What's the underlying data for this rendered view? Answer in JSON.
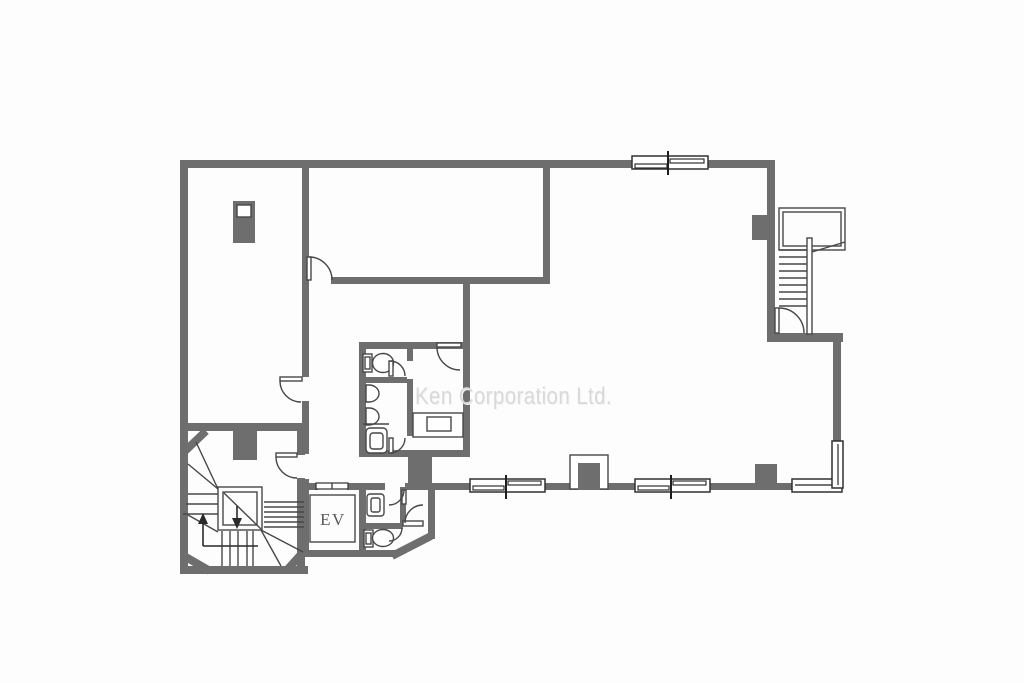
{
  "watermark": {
    "text": "Ken Corporation Ltd."
  },
  "labels": {
    "elevator": "EV"
  },
  "colors": {
    "background": "#fdfdfd",
    "wall": "#6e6e6e",
    "thin_line": "#474747",
    "window_frame": "#303030",
    "watermark": "#d9d9d9",
    "elevator_label": "#5a5a5a"
  },
  "plan": {
    "type": "floor-plan",
    "symbols": [
      "interior-winder-staircase",
      "up-arrow",
      "down-arrow",
      "elevator-cab",
      "elevator-door",
      "toilet",
      "urinal",
      "washbasin",
      "sink-counter",
      "door-swing-arc",
      "sliding-window",
      "exterior-staircase",
      "duct-shaft",
      "structural-pillar",
      "entrance-frame"
    ]
  }
}
